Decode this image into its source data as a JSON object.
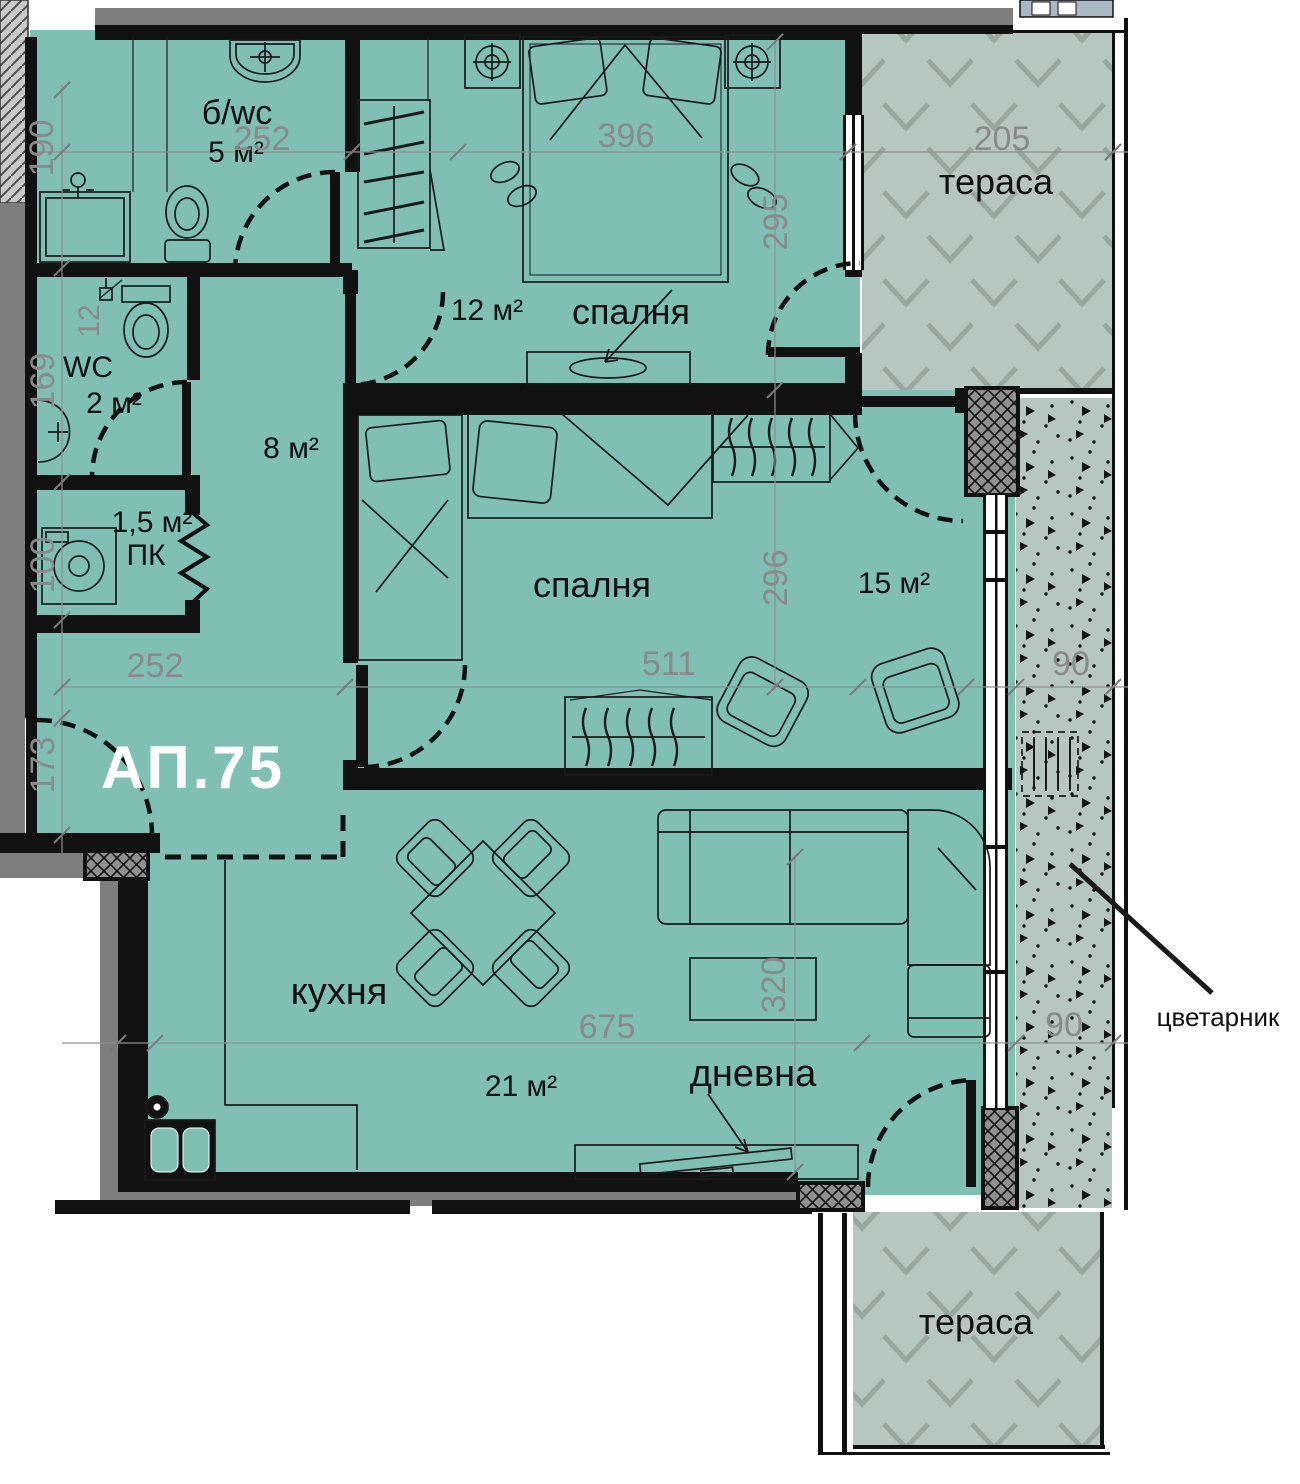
{
  "plan": {
    "apartment_number": "АП.75",
    "colors": {
      "interior": "#7fbfb4",
      "terrace": "#b6c7c1",
      "wall": "#111111",
      "exterior_grey": "#7e7e7e",
      "dimension_text": "#8a8a8a",
      "apartment_label": "#ffffff"
    }
  },
  "rooms": {
    "bathroom": {
      "name": "б/wc",
      "area": "5 м²"
    },
    "wc": {
      "name": "WC",
      "area": "2 м²"
    },
    "hall": {
      "area": "8 м²"
    },
    "storage": {
      "name": "ПК",
      "area": "1,5 м²"
    },
    "bedroom1": {
      "name": "спалня",
      "area": "12 м²"
    },
    "bedroom2": {
      "name": "спалня",
      "area": "15 м²"
    },
    "kitchen": {
      "name": "кухня"
    },
    "living": {
      "name": "дневна"
    },
    "living_kitchen_area": "21 м²",
    "terrace_top": {
      "name": "тераса"
    },
    "terrace_bottom": {
      "name": "тераса"
    },
    "flower_box": {
      "name": "цветарник"
    }
  },
  "dimensions": {
    "d190": "190",
    "d252a": "252",
    "d396": "396",
    "d205": "205",
    "d295": "295",
    "d12": "12",
    "d169": "169",
    "d100": "100",
    "d296": "296",
    "d252b": "252",
    "d511": "511",
    "d90a": "90",
    "d173": "173",
    "d675": "675",
    "d320": "320",
    "d90b": "90"
  }
}
